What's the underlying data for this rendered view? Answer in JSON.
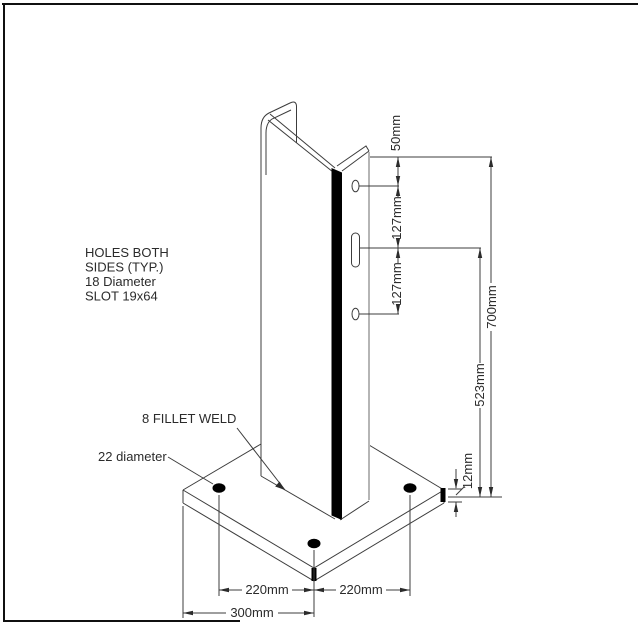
{
  "drawing": {
    "notes": {
      "holes_note_line1": "HOLES BOTH",
      "holes_note_line2": "SIDES (TYP.)",
      "holes_note_line3": "18 Diameter",
      "holes_note_line4": "SLOT 19x64",
      "weld_note": "8 FILLET WELD",
      "anchor_hole_note": "22 diameter"
    },
    "dimensions": {
      "top_hole_offset": "50mm",
      "hole_spacing_upper": "127mm",
      "hole_spacing_lower": "127mm",
      "overall_height": "700mm",
      "lower_hole_height": "523mm",
      "plate_thickness": "12mm",
      "bolt_spacing_left": "220mm",
      "bolt_spacing_right": "220mm",
      "plate_corner_to_center": "300mm"
    },
    "colors": {
      "line": "#3c3c3c",
      "edge_highlight": "#000000",
      "hidden_edge_gray": "#b5b5b5"
    }
  }
}
